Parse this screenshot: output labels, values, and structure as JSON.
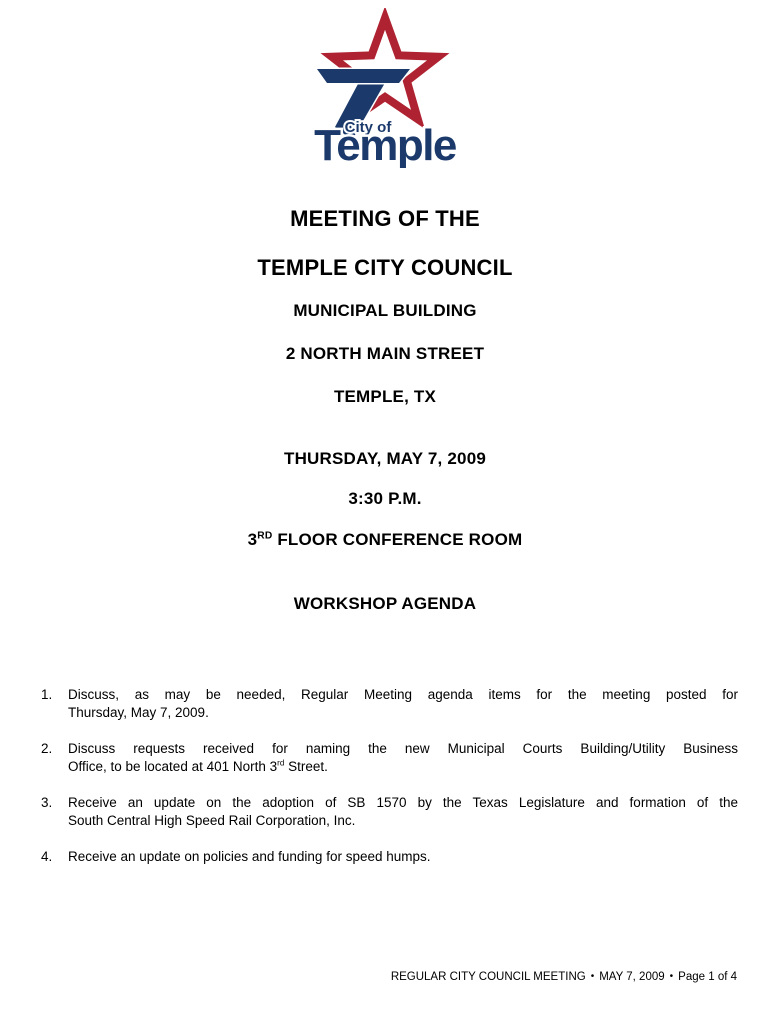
{
  "logo": {
    "city_of": "City of",
    "wordmark": "Temple",
    "star_color": "#AF2231",
    "navy_color": "#1B3A6B"
  },
  "header": {
    "title_line1": "MEETING OF THE",
    "title_line2": "TEMPLE CITY COUNCIL",
    "building": "MUNICIPAL BUILDING",
    "street": "2 NORTH MAIN STREET",
    "city_state": "TEMPLE, TX",
    "date": "THURSDAY, MAY 7, 2009",
    "time": "3:30 P.M.",
    "room_number": "3",
    "room_ordinal": "RD",
    "room_rest": " FLOOR CONFERENCE ROOM",
    "agenda_title": "WORKSHOP AGENDA"
  },
  "agenda_items": [
    {
      "number": "1.",
      "line1": "Discuss, as may be needed, Regular Meeting agenda items for the meeting posted for",
      "line2": "Thursday, May 7, 2009.",
      "full_text": "Discuss, as may be needed, Regular Meeting agenda items for the meeting posted for Thursday, May 7, 2009."
    },
    {
      "number": "2.",
      "line1": "Discuss requests received for naming the new Municipal Courts Building/Utility Business",
      "line2_part1": "Office, to be located at 401 North 3",
      "line2_ordinal": "rd",
      "line2_part2": " Street.",
      "full_text": "Discuss requests received for naming the new Municipal Courts Building/Utility Business Office, to be located at 401 North 3rd Street."
    },
    {
      "number": "3.",
      "line1": "Receive an update on the adoption of SB 1570 by the Texas Legislature and formation of the",
      "line2": "South Central High Speed Rail Corporation, Inc.",
      "full_text": "Receive an update on the adoption of SB 1570 by the Texas Legislature and formation of the South Central High Speed Rail Corporation, Inc."
    },
    {
      "number": "4.",
      "line1": "Receive an update on policies and funding for speed humps.",
      "full_text": "Receive an update on policies and funding for speed humps."
    }
  ],
  "footer": {
    "meeting_label": "REGULAR CITY COUNCIL MEETING",
    "bullet": "•",
    "date": "MAY 7, 2009",
    "page_label": "Page 1 of 4"
  }
}
